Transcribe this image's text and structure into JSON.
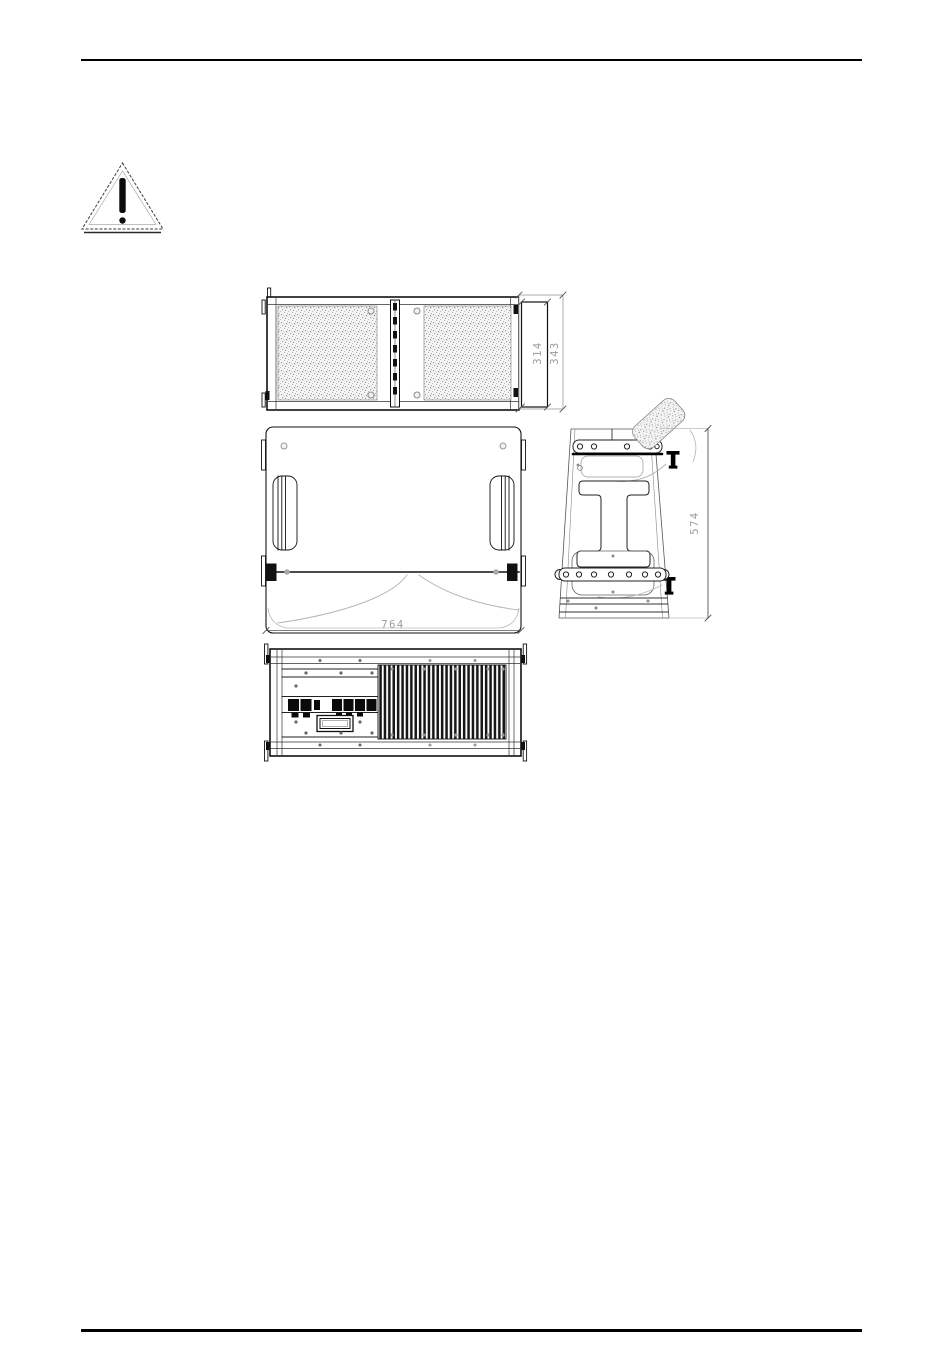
{
  "page": {
    "background": "#ffffff",
    "rule_color": "#000000"
  },
  "icons": {
    "warning": "warning-triangle"
  },
  "dimensions": {
    "depth_inner": "314",
    "depth_outer": "343",
    "width": "764",
    "height": "574"
  },
  "colors": {
    "line_dark": "#111111",
    "line_mid": "#555555",
    "line_light": "#b5b5b5",
    "dimension_text": "#9c9c9c",
    "grille_speckle": "#9a9a9a"
  }
}
